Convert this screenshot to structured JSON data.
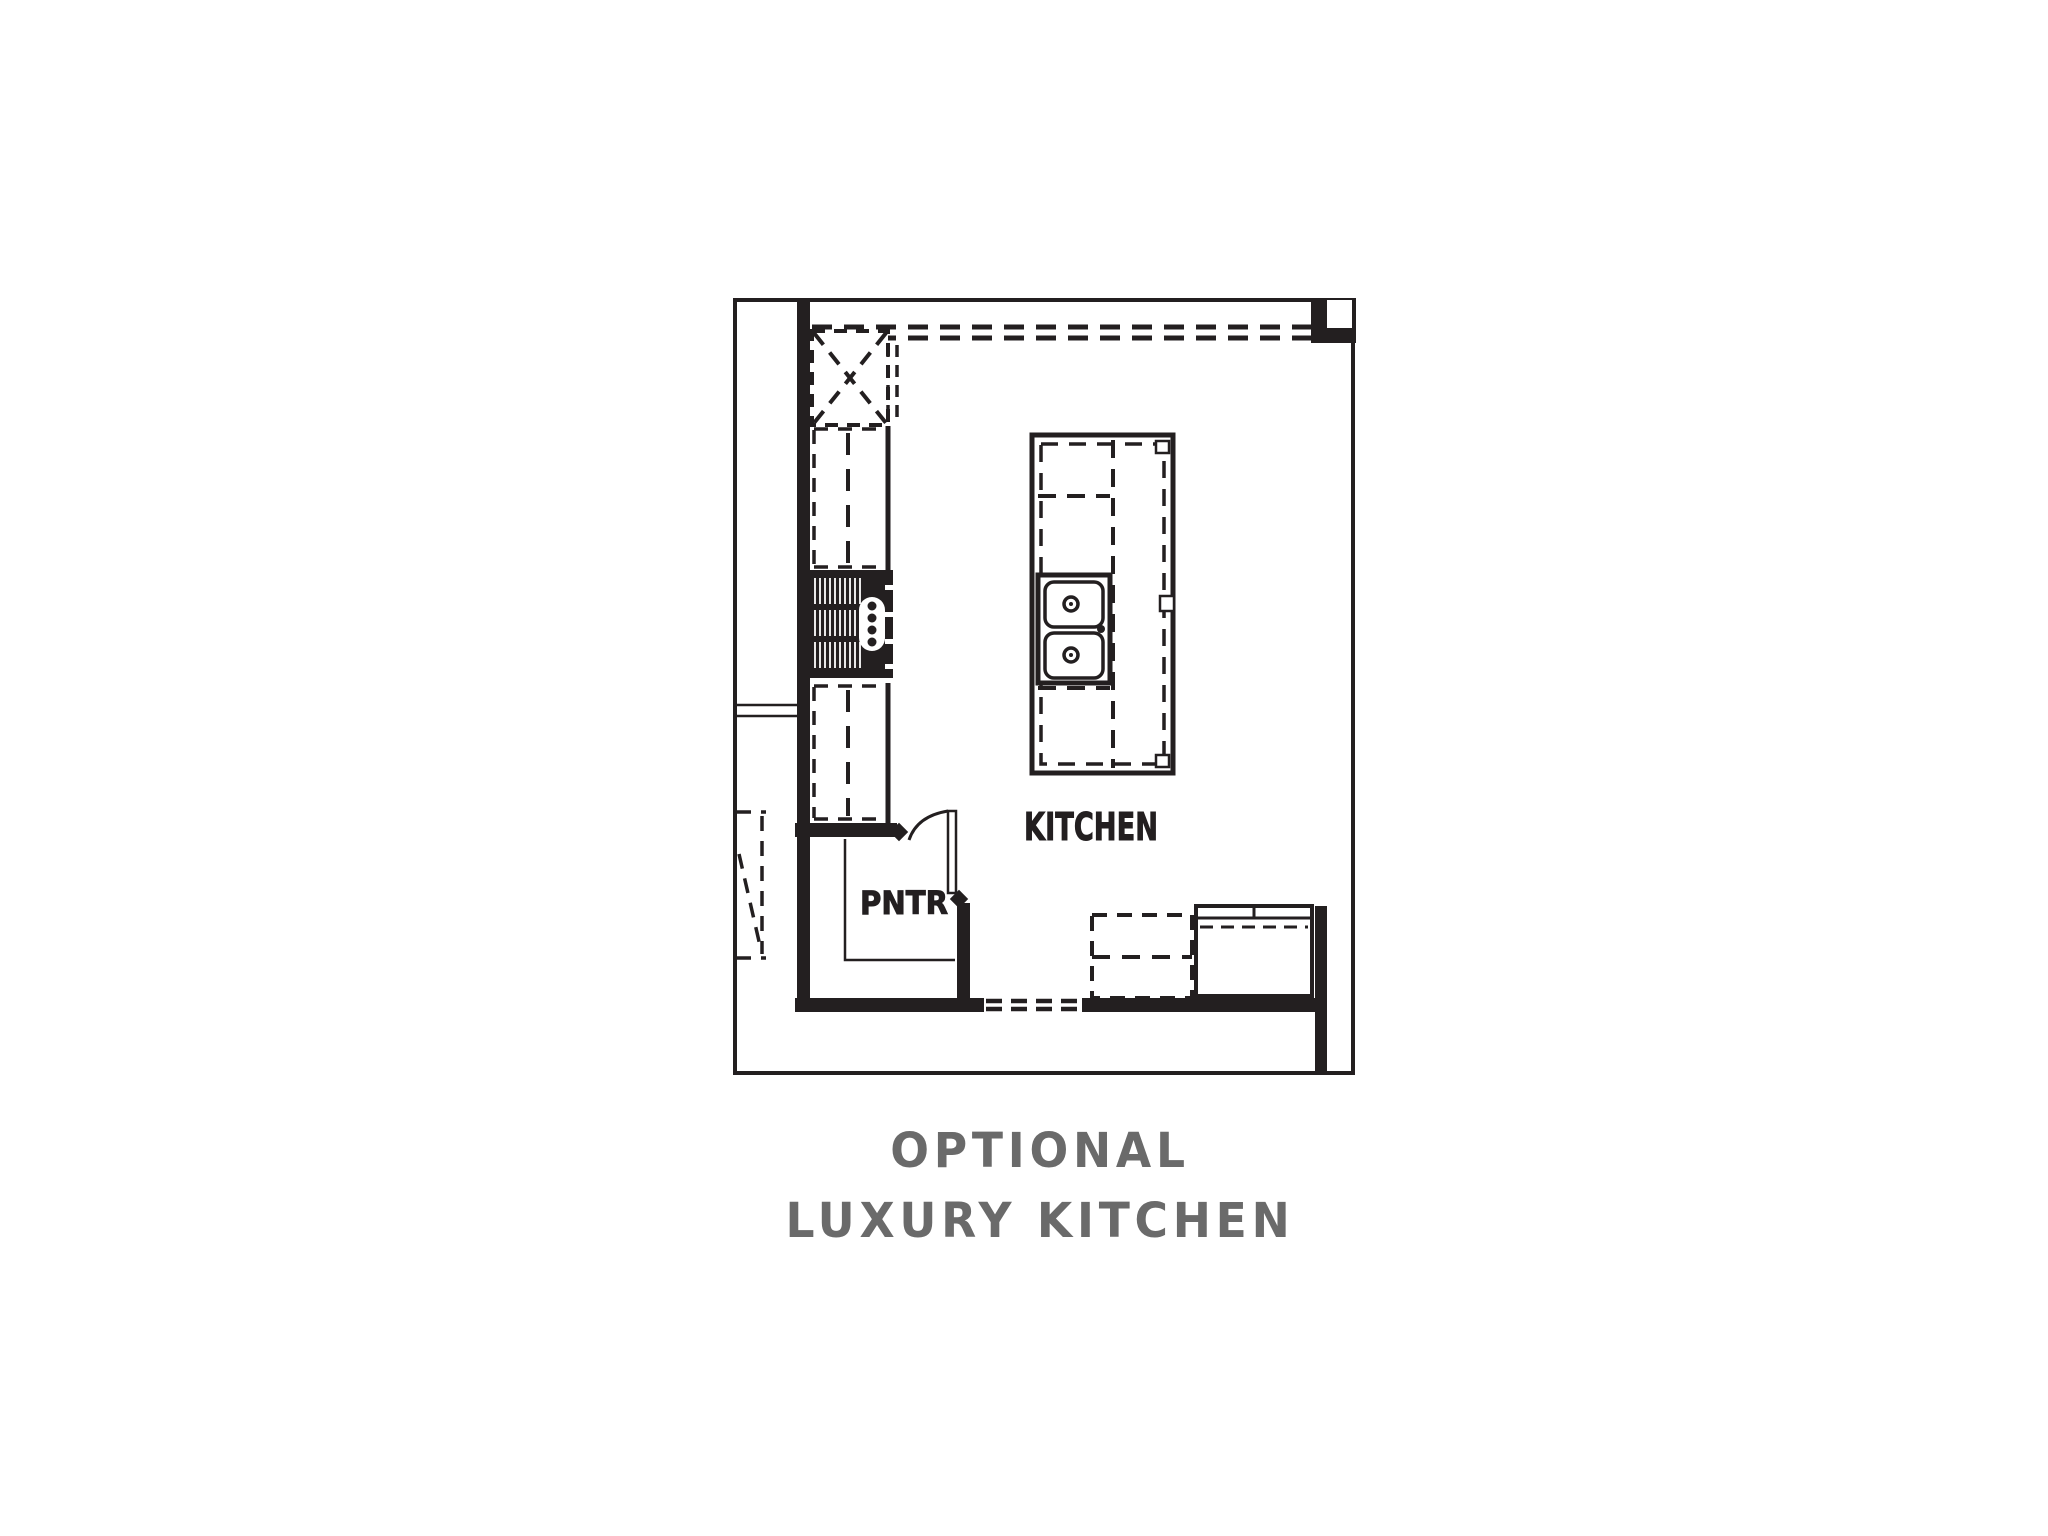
{
  "figure": {
    "type": "floor-plan",
    "labels": {
      "kitchen": "KITCHEN",
      "pantry": "PNTR"
    },
    "caption": {
      "line1": "OPTIONAL",
      "line2": "LUXURY KITCHEN"
    },
    "colors": {
      "ink": "#231f20",
      "caption_text": "#6a6a6a",
      "background": "#ffffff"
    }
  }
}
